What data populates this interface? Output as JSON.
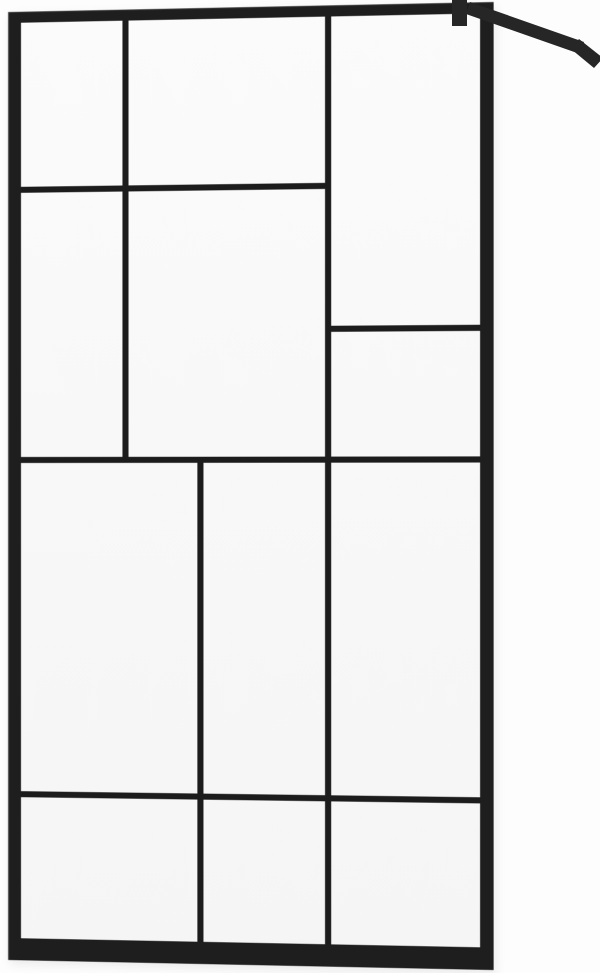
{
  "meta": {
    "description": "Product photo of a walk-in shower glass screen with a matte black industrial loft-style grid frame and a diagonal wall-mount support arm attached at the top right corner",
    "object": "shower-screen-panel"
  },
  "colors": {
    "background": "#fdfdfd",
    "frame": "#1e1e1e",
    "frame_highlight": "#4f4f4f",
    "mullion": "#1c1c1c",
    "glass": "#f8f8f8",
    "bracket": "#262626"
  },
  "panel": {
    "x": 8,
    "y": 12,
    "w": 476,
    "h": 948,
    "glass": {
      "x": 13,
      "y": 11,
      "w": 450,
      "h": 915
    },
    "mullions": [
      {
        "id": "v1-top-left",
        "x": 101,
        "y": 0,
        "w": 6,
        "h": 440
      },
      {
        "id": "v2-full-height",
        "x": 300,
        "y": 0,
        "w": 6,
        "h": 915
      },
      {
        "id": "v3-lower",
        "x": 175,
        "y": 434,
        "w": 6,
        "h": 481
      },
      {
        "id": "h1-upper-left",
        "x": 0,
        "y": 164,
        "w": 306,
        "h": 6
      },
      {
        "id": "h2-middle-full",
        "x": 0,
        "y": 434,
        "w": 450,
        "h": 6
      },
      {
        "id": "h3-right-column",
        "x": 300,
        "y": 305,
        "w": 150,
        "h": 6
      },
      {
        "id": "h4-lower-full",
        "x": 0,
        "y": 768,
        "w": 450,
        "h": 6
      }
    ]
  },
  "bracket": {
    "clamp": "452,0 467,0 467,26 452,26",
    "arm": "470,2 584,42 580,54 466,14",
    "wall_plate": "579,39 603,58 594,68 571,49"
  }
}
